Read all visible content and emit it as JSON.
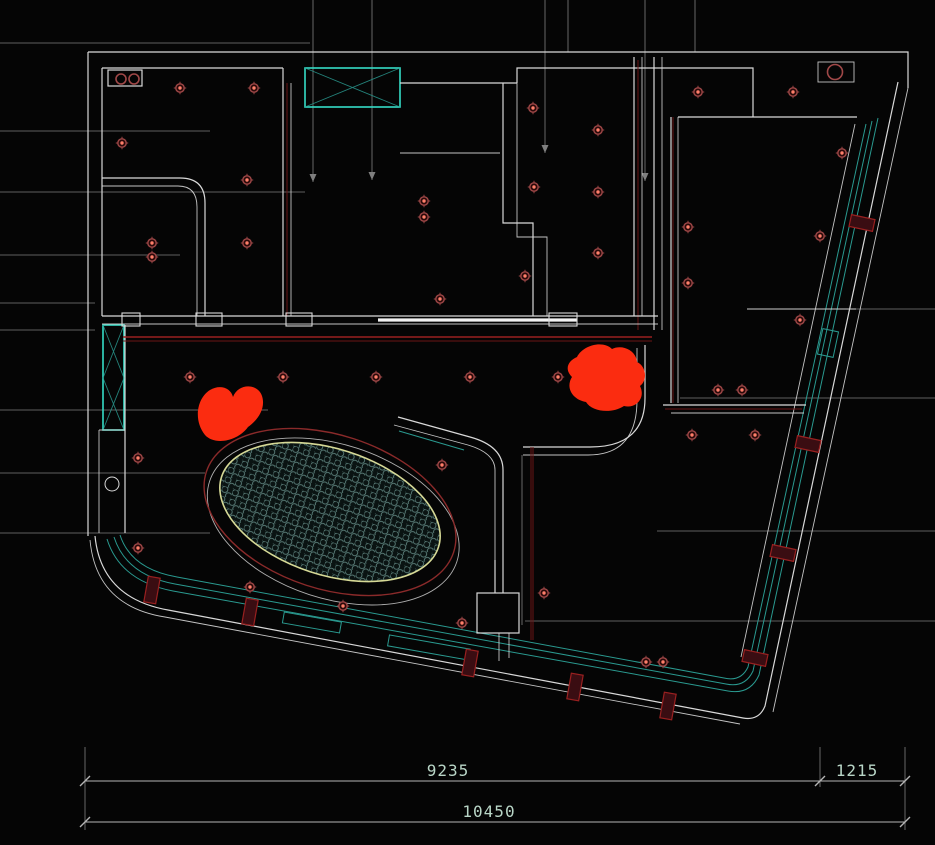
{
  "viewport": {
    "width": 935,
    "height": 845,
    "kind": "cad-ceiling-plan"
  },
  "colors": {
    "bg": "#050505",
    "wall": "#d9d9d9",
    "wallBright": "#f2f2f2",
    "leader": "#7f7f7f",
    "cyan": "#35dcc6",
    "cyanDim": "#2a9a90",
    "maroon": "#6b1515",
    "redline": "#992020",
    "dotRing": "#a04848",
    "dotCore": "#ff7f6a",
    "cloud": "#fb2c10",
    "hatchStroke": "#5d827d",
    "hatchBg": "#0a1312",
    "ellipseInner": "#d6d996",
    "ellipseOuter": "#8a2a2a",
    "dimLine": "#b5b5b5",
    "dimText": "#b9d6c7"
  },
  "dimensions": {
    "segment_a": "9235",
    "segment_b": "1215",
    "total": "10450"
  },
  "downlights": [
    [
      180,
      88
    ],
    [
      254,
      88
    ],
    [
      122,
      143
    ],
    [
      247,
      180
    ],
    [
      152,
      243
    ],
    [
      152,
      257
    ],
    [
      247,
      243
    ],
    [
      424,
      201
    ],
    [
      424,
      217
    ],
    [
      533,
      108
    ],
    [
      534,
      187
    ],
    [
      525,
      276
    ],
    [
      440,
      299
    ],
    [
      598,
      130
    ],
    [
      598,
      192
    ],
    [
      598,
      253
    ],
    [
      698,
      92
    ],
    [
      793,
      92
    ],
    [
      842,
      153
    ],
    [
      688,
      227
    ],
    [
      820,
      236
    ],
    [
      688,
      283
    ],
    [
      800,
      320
    ],
    [
      718,
      390
    ],
    [
      742,
      390
    ],
    [
      692,
      435
    ],
    [
      755,
      435
    ],
    [
      190,
      377
    ],
    [
      283,
      377
    ],
    [
      376,
      377
    ],
    [
      470,
      377
    ],
    [
      558,
      377
    ],
    [
      138,
      458
    ],
    [
      138,
      548
    ],
    [
      250,
      587
    ],
    [
      343,
      606
    ],
    [
      442,
      465
    ],
    [
      462,
      623
    ],
    [
      544,
      593
    ],
    [
      646,
      662
    ],
    [
      663,
      662
    ]
  ],
  "pair_downlights": [
    [
      121,
      79
    ],
    [
      134,
      79
    ]
  ],
  "ring_markers": [
    [
      835,
      72
    ]
  ],
  "port_markers": [
    [
      112,
      484
    ]
  ],
  "mullions": {
    "slant": [
      [
        862,
        223
      ],
      [
        808,
        444
      ],
      [
        783,
        553
      ],
      [
        755,
        658
      ]
    ],
    "bottom": [
      [
        152,
        590
      ],
      [
        250,
        612
      ],
      [
        470,
        663
      ],
      [
        575,
        687
      ],
      [
        668,
        706
      ]
    ]
  },
  "leaders": {
    "left": [
      [
        43,
        310
      ],
      [
        131,
        210
      ],
      [
        192,
        305
      ],
      [
        255,
        180
      ],
      [
        303,
        95
      ],
      [
        330,
        95
      ],
      [
        410,
        268
      ],
      [
        473,
        205
      ],
      [
        533,
        210
      ]
    ],
    "right": [
      [
        309,
        747
      ],
      [
        398,
        680
      ],
      [
        531,
        657
      ],
      [
        621,
        525
      ]
    ],
    "top": [
      [
        313,
        182
      ],
      [
        372,
        180
      ],
      [
        545,
        153
      ],
      [
        645,
        181
      ],
      [
        568,
        52
      ],
      [
        695,
        52
      ]
    ]
  }
}
